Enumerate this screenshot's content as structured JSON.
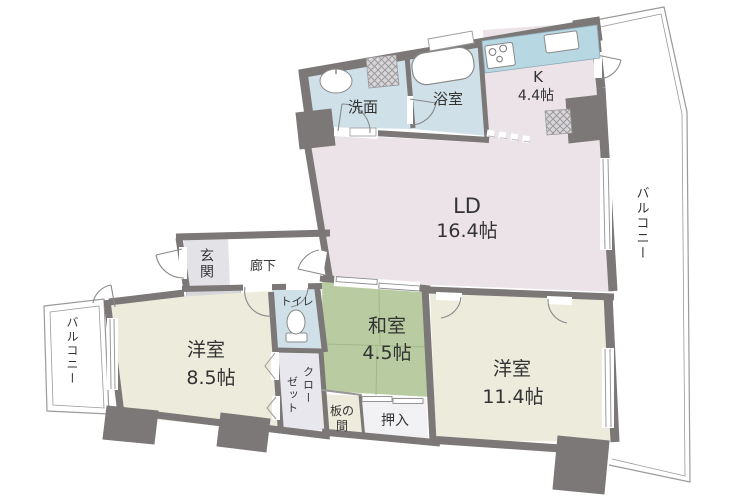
{
  "plan": {
    "type": "floorplan",
    "rooms": {
      "washroom": {
        "label": "洗面"
      },
      "bath": {
        "label": "浴室"
      },
      "kitchen": {
        "label": "K",
        "size": "4.4帖"
      },
      "living_dining": {
        "label": "LD",
        "size": "16.4帖"
      },
      "entrance": {
        "label": "玄関"
      },
      "hallway": {
        "label": "廊下"
      },
      "toilet": {
        "label": "トイレ"
      },
      "western_room_1": {
        "label": "洋室",
        "size": "8.5帖"
      },
      "japanese_room": {
        "label": "和室",
        "size": "4.5帖"
      },
      "western_room_2": {
        "label": "洋室",
        "size": "11.4帖"
      },
      "closet": {
        "label": "クローゼット",
        "col1": "クロー",
        "col2": "ゼット"
      },
      "wood_floor": {
        "label": "板の間",
        "line1": "板の",
        "line2": "間"
      },
      "futon_closet": {
        "label": "押入"
      },
      "balcony_right": {
        "label": "バルコニー"
      },
      "balcony_left": {
        "label": "バルコニー"
      }
    },
    "colors": {
      "wall": "#7b7877",
      "water_room": "#cfe0e9",
      "kitchen_counter": "#b7d7e2",
      "living_floor": "#ebe3e8",
      "western_floor": "#edebdc",
      "tatami": "#b9cba1",
      "entrance_floor": "#e3e2e7",
      "entrance_step": "#d7d6db",
      "closet_floor": "#e8e7ed",
      "futon_closet_floor": "#f2f1f4",
      "text": "#333333"
    }
  }
}
